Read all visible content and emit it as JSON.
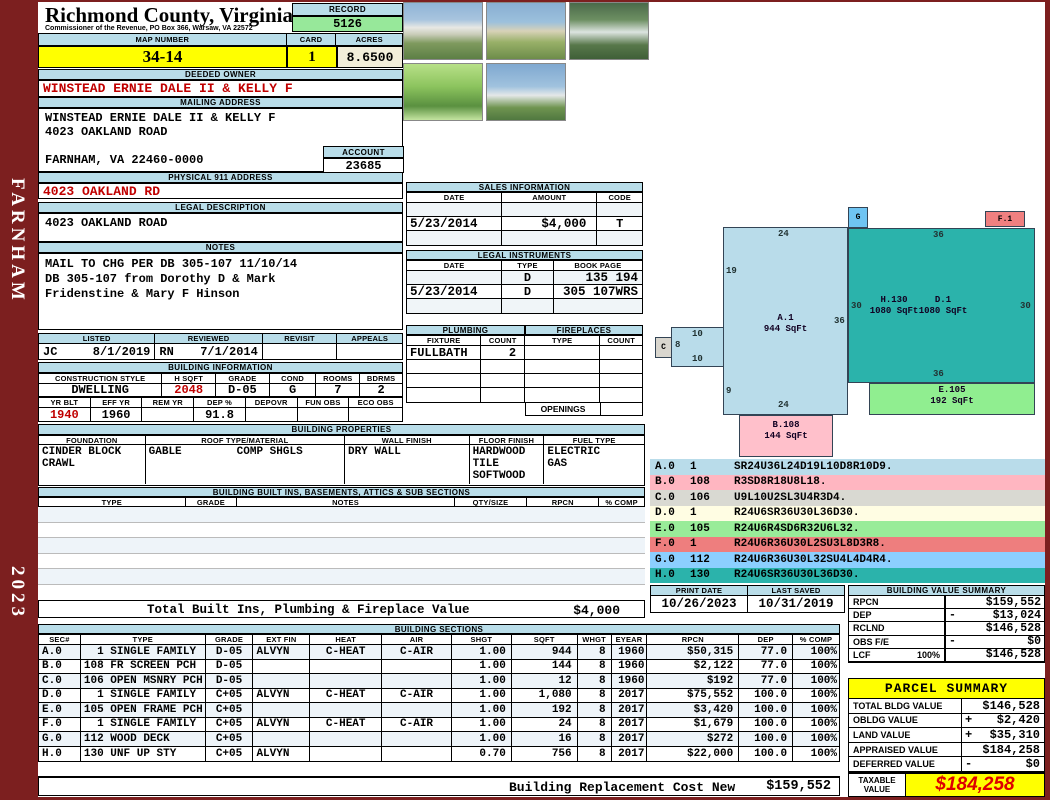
{
  "colors": {
    "header_bg": "#b9dde9",
    "maroon": "#7c1f1f",
    "highlight_yellow": "#ffff00",
    "record_green": "#97e89a",
    "acres_cream": "#f2eeda",
    "accent_red": "#c00000",
    "taxable_red": "#dd0000"
  },
  "sidebar": {
    "district": "FARNHAM",
    "year": "2023"
  },
  "header": {
    "county_title": "Richmond County, Virginia",
    "county_subtitle": "Commissioner of the Revenue, PO Box 366, Warsaw, VA 22572",
    "record_label": "RECORD",
    "record_value": "5126",
    "map_label": "MAP NUMBER",
    "map_value": "34-14",
    "card_label": "CARD",
    "card_value": "1",
    "acres_label": "ACRES",
    "acres_value": "8.6500"
  },
  "owner": {
    "deeded_label": "DEEDED OWNER",
    "deeded_value": "WINSTEAD ERNIE DALE II & KELLY F",
    "mailing_label": "MAILING ADDRESS",
    "mailing_line1": "WINSTEAD ERNIE DALE II & KELLY F",
    "mailing_line2": "4023 OAKLAND ROAD",
    "mailing_line3": "FARNHAM, VA 22460-0000",
    "account_label": "ACCOUNT",
    "account_value": "23685"
  },
  "address": {
    "physical_label": "PHYSICAL 911 ADDRESS",
    "physical_value": "4023 OAKLAND RD",
    "legal_label": "LEGAL DESCRIPTION",
    "legal_value": "4023 OAKLAND ROAD",
    "notes_label": "NOTES",
    "notes_line1": "MAIL TO CHG PER DB 305-107 11/10/14",
    "notes_line2": "DB 305-107 from Dorothy D & Mark",
    "notes_line3": "Fridenstine & Mary F Hinson"
  },
  "review": {
    "listed_label": "LISTED",
    "reviewed_label": "REVIEWED",
    "revisit_label": "REVISIT",
    "appeals_label": "APPEALS",
    "listed_by": "JC",
    "listed_date": "8/1/2019",
    "reviewed_by": "RN",
    "reviewed_date": "7/1/2014",
    "revisit_value": "",
    "appeals_value": ""
  },
  "building_info": {
    "title": "BUILDING INFORMATION",
    "style_label": "CONSTRUCTION STYLE",
    "style": "DWELLING",
    "hsqft_label": "H SQFT",
    "hsqft": "2048",
    "grade_label": "GRADE",
    "grade": "D-05",
    "cond_label": "COND",
    "cond": "G",
    "rooms_label": "ROOMS",
    "rooms": "7",
    "bdrms_label": "BDRMS",
    "bdrms": "2",
    "yrblt_label": "YR BLT",
    "yrblt": "1940",
    "effyr_label": "EFF YR",
    "effyr": "1960",
    "remyr_label": "REM YR",
    "remyr": "",
    "dep_label": "DEP %",
    "dep": "91.8",
    "depovr_label": "DEPOVR",
    "depovr": "",
    "funobs_label": "FUN OBS",
    "funobs": "",
    "ecoobs_label": "ECO OBS",
    "ecoobs": ""
  },
  "sales": {
    "title": "SALES INFORMATION",
    "date_h": "DATE",
    "amount_h": "AMOUNT",
    "code_h": "CODE",
    "rows": [
      {
        "date": "",
        "amount": "",
        "code": ""
      },
      {
        "date": "5/23/2014",
        "amount": "$4,000",
        "code": "T"
      },
      {
        "date": "",
        "amount": "",
        "code": ""
      }
    ]
  },
  "legal_instruments": {
    "title": "LEGAL INSTRUMENTS",
    "date_h": "DATE",
    "type_h": "TYPE",
    "book_h": "BOOK PAGE",
    "rows": [
      {
        "date": "",
        "type": "D",
        "book": "135 194"
      },
      {
        "date": "5/23/2014",
        "type": "D",
        "book": "305 107WRS"
      },
      {
        "date": "",
        "type": "",
        "book": ""
      }
    ]
  },
  "plumbing": {
    "title": "PLUMBING",
    "fixture_h": "FIXTURE",
    "count_h": "COUNT",
    "rows": [
      {
        "fixture": "FULLBATH",
        "count": "2",
        "ftype": "",
        "fcount": ""
      },
      {
        "fixture": "",
        "count": "",
        "ftype": "",
        "fcount": ""
      },
      {
        "fixture": "",
        "count": "",
        "ftype": "",
        "fcount": ""
      },
      {
        "fixture": "",
        "count": "",
        "ftype": "",
        "fcount": ""
      }
    ]
  },
  "fireplaces": {
    "title": "FIREPLACES",
    "type_h": "TYPE",
    "count_h": "COUNT",
    "openings_label": "OPENINGS",
    "openings_value": ""
  },
  "building_properties": {
    "title": "BUILDING PROPERTIES",
    "foundation_h": "FOUNDATION",
    "foundation1": "CINDER BLOCK",
    "foundation2": "CRAWL",
    "roof_h": "ROOF TYPE/MATERIAL",
    "roof1": "GABLE",
    "roof2": "COMP SHGLS",
    "wall_h": "WALL FINISH",
    "wall1": "DRY WALL",
    "floor_h": "FLOOR FINISH",
    "floor1": "HARDWOOD",
    "floor2": "TILE",
    "floor3": "SOFTWOOD",
    "fuel_h": "FUEL TYPE",
    "fuel1": "ELECTRIC",
    "fuel2": "GAS"
  },
  "built_ins": {
    "title": "BUILDING BUILT INS, BASEMENTS, ATTICS & SUB SECTIONS",
    "type_h": "TYPE",
    "grade_h": "GRADE",
    "notes_h": "NOTES",
    "qty_h": "QTY/SIZE",
    "rpcn_h": "RPCN",
    "comp_h": "% COMP",
    "total_label": "Total Built Ins, Plumbing & Fireplace Value",
    "total_value": "$4,000"
  },
  "building_sections": {
    "title": "BUILDING SECTIONS",
    "headers": {
      "sec": "SEC#",
      "type": "TYPE",
      "grade": "GRADE",
      "extfin": "EXT FIN",
      "heat": "HEAT",
      "air": "AIR",
      "shgt": "SHGT",
      "sqft": "SQFT",
      "whgt": "WHGT",
      "eyear": "EYEAR",
      "rpcn": "RPCN",
      "dep": "DEP",
      "comp": "% COMP"
    },
    "rows": [
      {
        "sec": "A.0",
        "type": "  1 SINGLE FAMILY",
        "grade": "D-05",
        "extfin": "ALVYN",
        "heat": "C-HEAT",
        "air": "C-AIR",
        "shgt": "1.00",
        "sqft": "944",
        "whgt": "8",
        "eyear": "1960",
        "rpcn": "$50,315",
        "dep": "77.0",
        "comp": "100%"
      },
      {
        "sec": "B.0",
        "type": "108 FR SCREEN PCH",
        "grade": "D-05",
        "extfin": "",
        "heat": "",
        "air": "",
        "shgt": "1.00",
        "sqft": "144",
        "whgt": "8",
        "eyear": "1960",
        "rpcn": "$2,122",
        "dep": "77.0",
        "comp": "100%"
      },
      {
        "sec": "C.0",
        "type": "106 OPEN MSNRY PCH",
        "grade": "D-05",
        "extfin": "",
        "heat": "",
        "air": "",
        "shgt": "1.00",
        "sqft": "12",
        "whgt": "8",
        "eyear": "1960",
        "rpcn": "$192",
        "dep": "77.0",
        "comp": "100%"
      },
      {
        "sec": "D.0",
        "type": "  1 SINGLE FAMILY",
        "grade": "C+05",
        "extfin": "ALVYN",
        "heat": "C-HEAT",
        "air": "C-AIR",
        "shgt": "1.00",
        "sqft": "1,080",
        "whgt": "8",
        "eyear": "2017",
        "rpcn": "$75,552",
        "dep": "100.0",
        "comp": "100%"
      },
      {
        "sec": "E.0",
        "type": "105 OPEN FRAME PCH",
        "grade": "C+05",
        "extfin": "",
        "heat": "",
        "air": "",
        "shgt": "1.00",
        "sqft": "192",
        "whgt": "8",
        "eyear": "2017",
        "rpcn": "$3,420",
        "dep": "100.0",
        "comp": "100%"
      },
      {
        "sec": "F.0",
        "type": "  1 SINGLE FAMILY",
        "grade": "C+05",
        "extfin": "ALVYN",
        "heat": "C-HEAT",
        "air": "C-AIR",
        "shgt": "1.00",
        "sqft": "24",
        "whgt": "8",
        "eyear": "2017",
        "rpcn": "$1,679",
        "dep": "100.0",
        "comp": "100%"
      },
      {
        "sec": "G.0",
        "type": "112 WOOD DECK",
        "grade": "C+05",
        "extfin": "",
        "heat": "",
        "air": "",
        "shgt": "1.00",
        "sqft": "16",
        "whgt": "8",
        "eyear": "2017",
        "rpcn": "$272",
        "dep": "100.0",
        "comp": "100%"
      },
      {
        "sec": "H.0",
        "type": "130 UNF UP STY",
        "grade": "C+05",
        "extfin": "ALVYN",
        "heat": "",
        "air": "",
        "shgt": "0.70",
        "sqft": "756",
        "whgt": "8",
        "eyear": "2017",
        "rpcn": "$22,000",
        "dep": "100.0",
        "comp": "100%"
      }
    ],
    "replacement_label": "Building Replacement Cost New",
    "replacement_value": "$159,552"
  },
  "sketch": {
    "legend": [
      {
        "code": "A.0",
        "qty": "1",
        "vector": "SR24U36L24D19L10D8R10D9.",
        "color": "#b9dcea"
      },
      {
        "code": "B.0",
        "qty": "108",
        "vector": "R3SD8R18U8L18.",
        "color": "#ffb6c1"
      },
      {
        "code": "C.0",
        "qty": "106",
        "vector": "U9L10U2SL3U4R3D4.",
        "color": "#d9d9d2"
      },
      {
        "code": "D.0",
        "qty": "1",
        "vector": "R24U6SR36U30L36D30.",
        "color": "#fffde3"
      },
      {
        "code": "E.0",
        "qty": "105",
        "vector": "R24U6R4SD6R32U6L32.",
        "color": "#99ec99"
      },
      {
        "code": "F.0",
        "qty": "1",
        "vector": "R24U6R36U30L2SU3L8D3R8.",
        "color": "#ee7e7e"
      },
      {
        "code": "G.0",
        "qty": "112",
        "vector": "R24U6R36U30L32SU4L4D4R4.",
        "color": "#8ccfff"
      },
      {
        "code": "H.0",
        "qty": "130",
        "vector": "R24U6SR36U30L36D30.",
        "color": "#2bb3ab"
      }
    ],
    "labels": {
      "a": "A.1",
      "a_sqft": "944 SqFt",
      "b": "B.108",
      "b_sqft": "144 SqFt",
      "c": "C",
      "d": "D.1",
      "d_sqft": "1080 SqFt",
      "e": "E.105",
      "e_sqft": "192 SqFt",
      "f": "F.1",
      "g": "G",
      "h": "H.130",
      "h_sqft": "1080 SqFt"
    },
    "dims": {
      "a_top": "24",
      "a_left": "19",
      "notch_top": "10",
      "notch_left": "8",
      "notch_bottom": "10",
      "a_lower_left": "9",
      "a_bottom": "24",
      "a_right": "36",
      "h_left": "30",
      "h_top": "36",
      "h_right": "30",
      "h_bottom": "36"
    }
  },
  "dates": {
    "print_label": "PRINT DATE",
    "print_value": "10/26/2023",
    "saved_label": "LAST SAVED",
    "saved_value": "10/31/2019"
  },
  "value_summary": {
    "title": "BUILDING VALUE SUMMARY",
    "rows": [
      {
        "label": "RPCN",
        "pct": "",
        "sign": "",
        "amount": "$159,552"
      },
      {
        "label": "DEP",
        "pct": "",
        "sign": "-",
        "amount": "$13,024"
      },
      {
        "label": "RCLND",
        "pct": "",
        "sign": "",
        "amount": "$146,528"
      },
      {
        "label": "OBS F/E",
        "pct": "",
        "sign": "-",
        "amount": "$0"
      },
      {
        "label": "LCF",
        "pct": "100%",
        "sign": "",
        "amount": "$146,528"
      }
    ]
  },
  "parcel_summary": {
    "title": "PARCEL SUMMARY",
    "rows": [
      {
        "label": "TOTAL BLDG VALUE",
        "sign": "",
        "amount": "$146,528"
      },
      {
        "label": "OBLDG VALUE",
        "sign": "+",
        "amount": "$2,420"
      },
      {
        "label": "LAND VALUE",
        "sign": "+",
        "amount": "$35,310"
      },
      {
        "label": "APPRAISED VALUE",
        "sign": "",
        "amount": "$184,258"
      },
      {
        "label": "DEFERRED VALUE",
        "sign": "-",
        "amount": "$0"
      }
    ],
    "taxable_label": "TAXABLE VALUE",
    "taxable_amount": "$184,258"
  },
  "photos": {
    "descriptions": [
      "house front with screened porch",
      "house with red door",
      "house among trees",
      "yard foliage",
      "two-story house"
    ]
  }
}
